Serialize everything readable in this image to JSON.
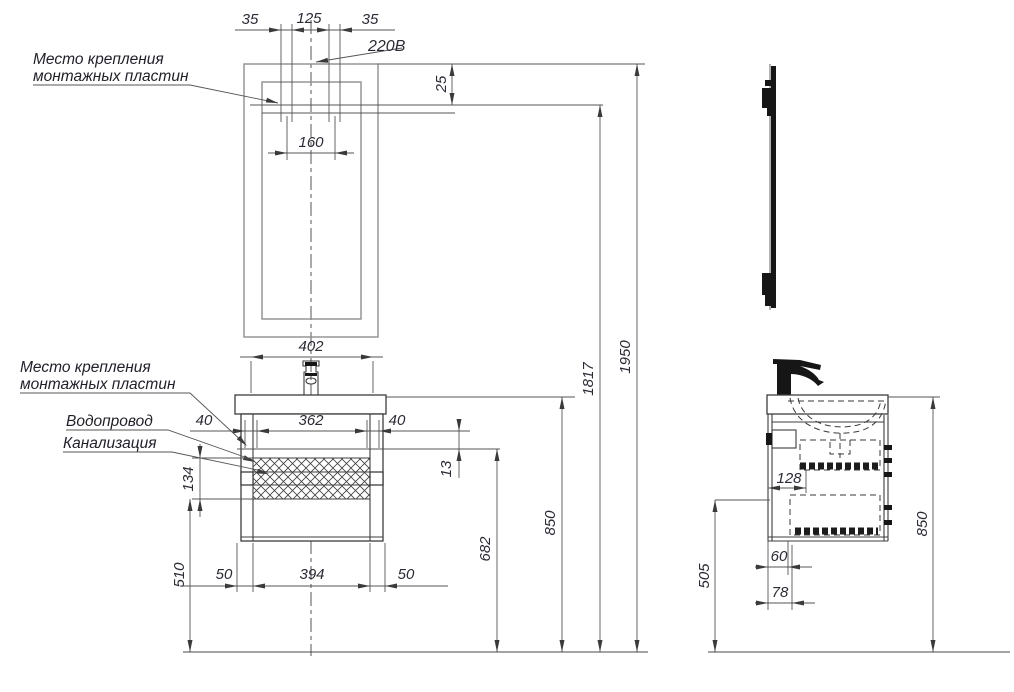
{
  "annotations": {
    "mounting_plates_mirror": {
      "line1": "Место крепления",
      "line2": "монтажных пластин"
    },
    "mounting_plates_cabinet": {
      "line1": "Место крепления",
      "line2": "монтажных пластин"
    },
    "water_supply": "Водопровод",
    "sewerage": "Канализация",
    "power": "220В"
  },
  "front_view": {
    "dimensions": {
      "plate_offset_left": "35",
      "plate_spacing": "125",
      "plate_offset_right": "35",
      "mirror_top_to_plates": "25",
      "plate_centers": "160",
      "washbasin_width": "402",
      "cabinet_plate_offset_left": "40",
      "cabinet_plate_spacing": "362",
      "cabinet_plate_offset_right": "40",
      "pipe_offset": "13",
      "pipe_zone_height": "134",
      "bottom_zone_height": "510",
      "leg_offset_left": "50",
      "leg_spacing": "394",
      "leg_offset_right": "50",
      "cabinet_plates_height": "682",
      "worktop_height": "850",
      "mirror_plates_height": "1817",
      "mirror_top_height": "1950"
    }
  },
  "side_view": {
    "dimensions": {
      "drawer_depth": "128",
      "lower_zone_height": "505",
      "water_pipe_depth": "60",
      "sewer_pipe_depth": "78",
      "worktop_height": "850"
    }
  },
  "colors": {
    "line": "#4a4a4a",
    "mirror_outline": "#8f8f8f",
    "text": "#2b2b35",
    "background": "#ffffff"
  }
}
